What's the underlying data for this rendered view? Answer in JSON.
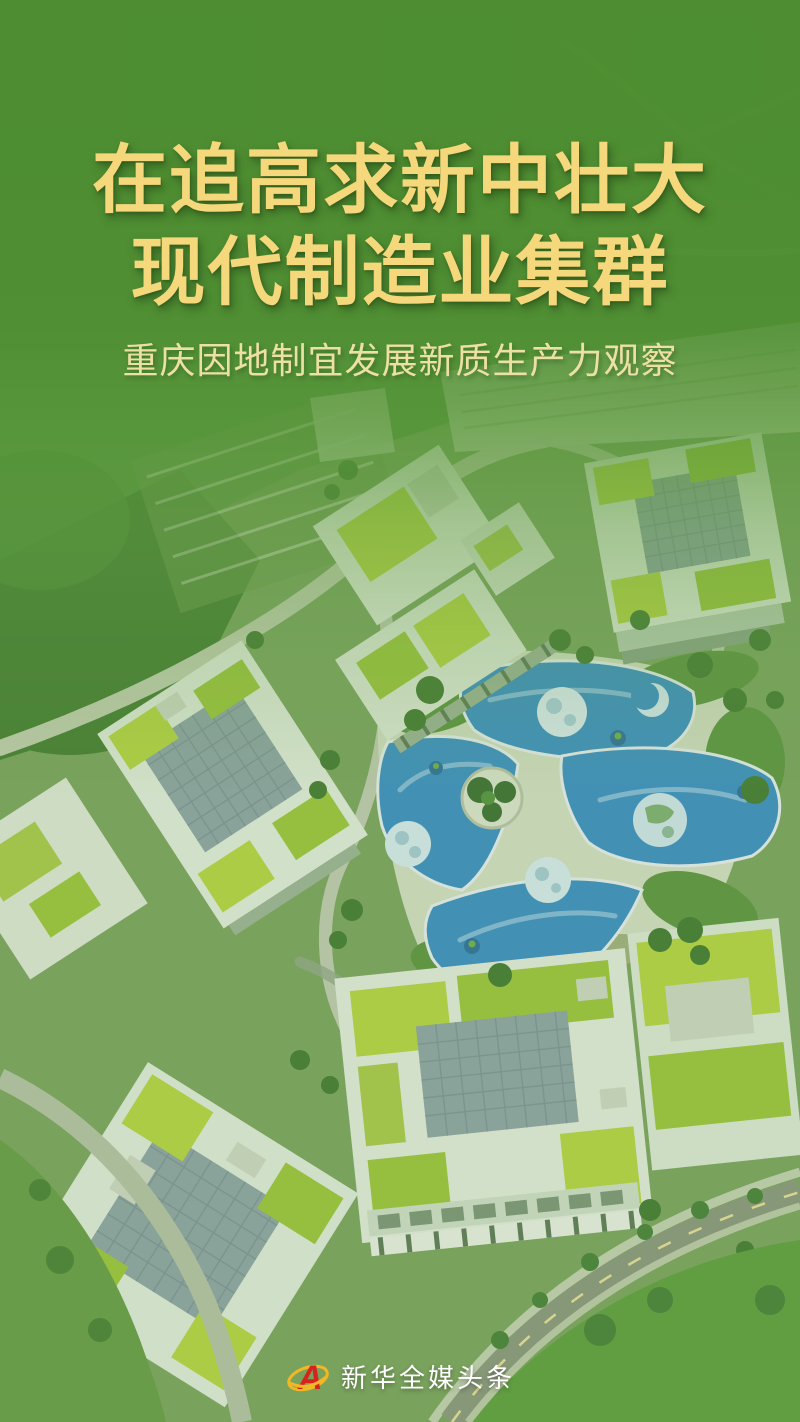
{
  "poster": {
    "title": {
      "line1": "在追高求新中壮大",
      "line2": "现代制造业集群"
    },
    "subtitle": "重庆因地制宜发展新质生产力观察",
    "footer": {
      "brand": "新华全媒头条",
      "logo_letter": "A"
    },
    "colors": {
      "title_gold": "#F5D77C",
      "subtitle_gold": "#ECE0A2",
      "overlay_green": "#4E8D31",
      "brand_red": "#D7231D",
      "brand_gold": "#F2B824",
      "footer_text": "#FFFFFF",
      "roof_blue": "#3B8FC5",
      "green_roof": "#B6D343"
    }
  }
}
